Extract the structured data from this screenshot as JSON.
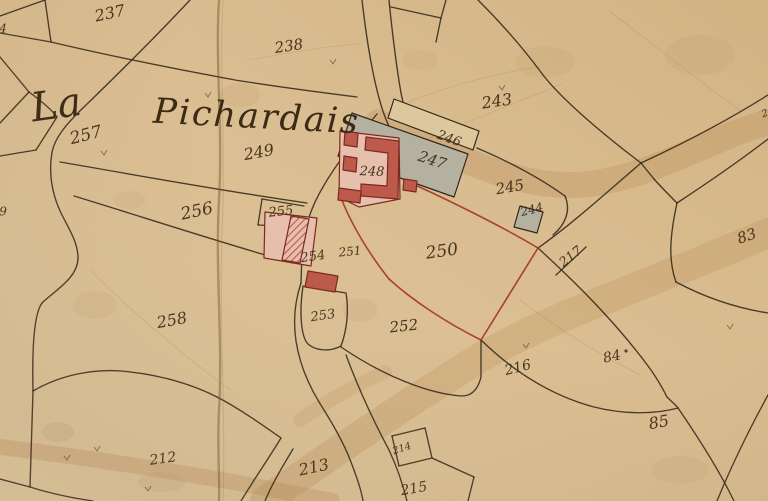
{
  "map": {
    "place_name": {
      "word1": "La",
      "word2": "Pichardais"
    },
    "colors": {
      "parchment": "#dcc094",
      "parchment_light": "#e4cda6",
      "parchment_dark": "#d2b384",
      "ink": "#32281a",
      "label_ink": "#3a2a16",
      "red_boundary": "#a3322a",
      "building_red": "#bd5a4b",
      "building_red_dark": "#7c2a20",
      "building_pink": "#e6bfad",
      "building_gray": "#b5b1a0",
      "building_outlined": "#ddc79c",
      "wash_brown": "#b98a55",
      "stain_brown": "#8a6a3a",
      "crease_brown": "#715узнать"
    },
    "parcel_labels": [
      {
        "text": "237",
        "x": 110,
        "y": 14,
        "size": 16,
        "rot": -12
      },
      {
        "text": "238",
        "x": 289,
        "y": 47,
        "size": 15,
        "rot": -8
      },
      {
        "text": "243",
        "x": 497,
        "y": 102,
        "size": 16,
        "rot": -8
      },
      {
        "text": "257",
        "x": 86,
        "y": 136,
        "size": 17,
        "rot": -14
      },
      {
        "text": "249",
        "x": 259,
        "y": 153,
        "size": 16,
        "rot": -10
      },
      {
        "text": "246",
        "x": 449,
        "y": 139,
        "size": 13,
        "rot": 20
      },
      {
        "text": "247",
        "x": 432,
        "y": 161,
        "size": 15,
        "rot": 18
      },
      {
        "text": "248",
        "x": 372,
        "y": 172,
        "size": 13,
        "rot": 2
      },
      {
        "text": "245",
        "x": 510,
        "y": 188,
        "size": 15,
        "rot": -10
      },
      {
        "text": "244",
        "x": 532,
        "y": 210,
        "size": 12,
        "rot": -14
      },
      {
        "text": "255",
        "x": 281,
        "y": 212,
        "size": 13,
        "rot": -6
      },
      {
        "text": "256",
        "x": 197,
        "y": 212,
        "size": 17,
        "rot": -12
      },
      {
        "text": "254",
        "x": 313,
        "y": 257,
        "size": 13,
        "rot": -8
      },
      {
        "text": "251",
        "x": 350,
        "y": 252,
        "size": 12,
        "rot": -6
      },
      {
        "text": "250",
        "x": 442,
        "y": 252,
        "size": 17,
        "rot": -8
      },
      {
        "text": "217",
        "x": 571,
        "y": 257,
        "size": 13,
        "rot": -38
      },
      {
        "text": "253",
        "x": 323,
        "y": 316,
        "size": 13,
        "rot": -8
      },
      {
        "text": "258",
        "x": 172,
        "y": 321,
        "size": 16,
        "rot": -10
      },
      {
        "text": "252",
        "x": 404,
        "y": 327,
        "size": 15,
        "rot": -6
      },
      {
        "text": "216",
        "x": 518,
        "y": 368,
        "size": 14,
        "rot": -14
      },
      {
        "text": "84",
        "x": 612,
        "y": 357,
        "size": 14,
        "rot": -12
      },
      {
        "text": "83",
        "x": 747,
        "y": 237,
        "size": 15,
        "rot": -18
      },
      {
        "text": "85",
        "x": 659,
        "y": 423,
        "size": 16,
        "rot": -10
      },
      {
        "text": "212",
        "x": 163,
        "y": 459,
        "size": 14,
        "rot": -8
      },
      {
        "text": "213",
        "x": 314,
        "y": 468,
        "size": 16,
        "rot": -12
      },
      {
        "text": "214",
        "x": 402,
        "y": 449,
        "size": 10,
        "rot": -18
      },
      {
        "text": "215",
        "x": 414,
        "y": 489,
        "size": 14,
        "rot": -10
      },
      {
        "text": "4",
        "x": 3,
        "y": 29,
        "size": 12,
        "rot": 0
      },
      {
        "text": "9",
        "x": 3,
        "y": 212,
        "size": 12,
        "rot": 0
      },
      {
        "text": "2",
        "x": 765,
        "y": 114,
        "size": 10,
        "rot": -20
      }
    ],
    "buildings": [
      {
        "name": "building-246",
        "fill_key": "building_outlined"
      },
      {
        "name": "building-247",
        "fill_key": "building_gray"
      },
      {
        "name": "building-244",
        "fill_key": "building_gray"
      },
      {
        "name": "building-248-courtyard",
        "fill_key": "building_pink"
      },
      {
        "name": "building-248-main",
        "fill_key": "building_red"
      },
      {
        "name": "building-248-annex-1",
        "fill_key": "building_red"
      },
      {
        "name": "building-248-annex-2",
        "fill_key": "building_red"
      },
      {
        "name": "building-248-annex-3",
        "fill_key": "building_red"
      },
      {
        "name": "building-248-annex-4",
        "fill_key": "building_red"
      },
      {
        "name": "building-254-yard",
        "fill_key": "building_pink"
      },
      {
        "name": "building-254-main",
        "fill_key": "hatch"
      },
      {
        "name": "building-254-barn",
        "fill_key": "building_red"
      }
    ]
  }
}
